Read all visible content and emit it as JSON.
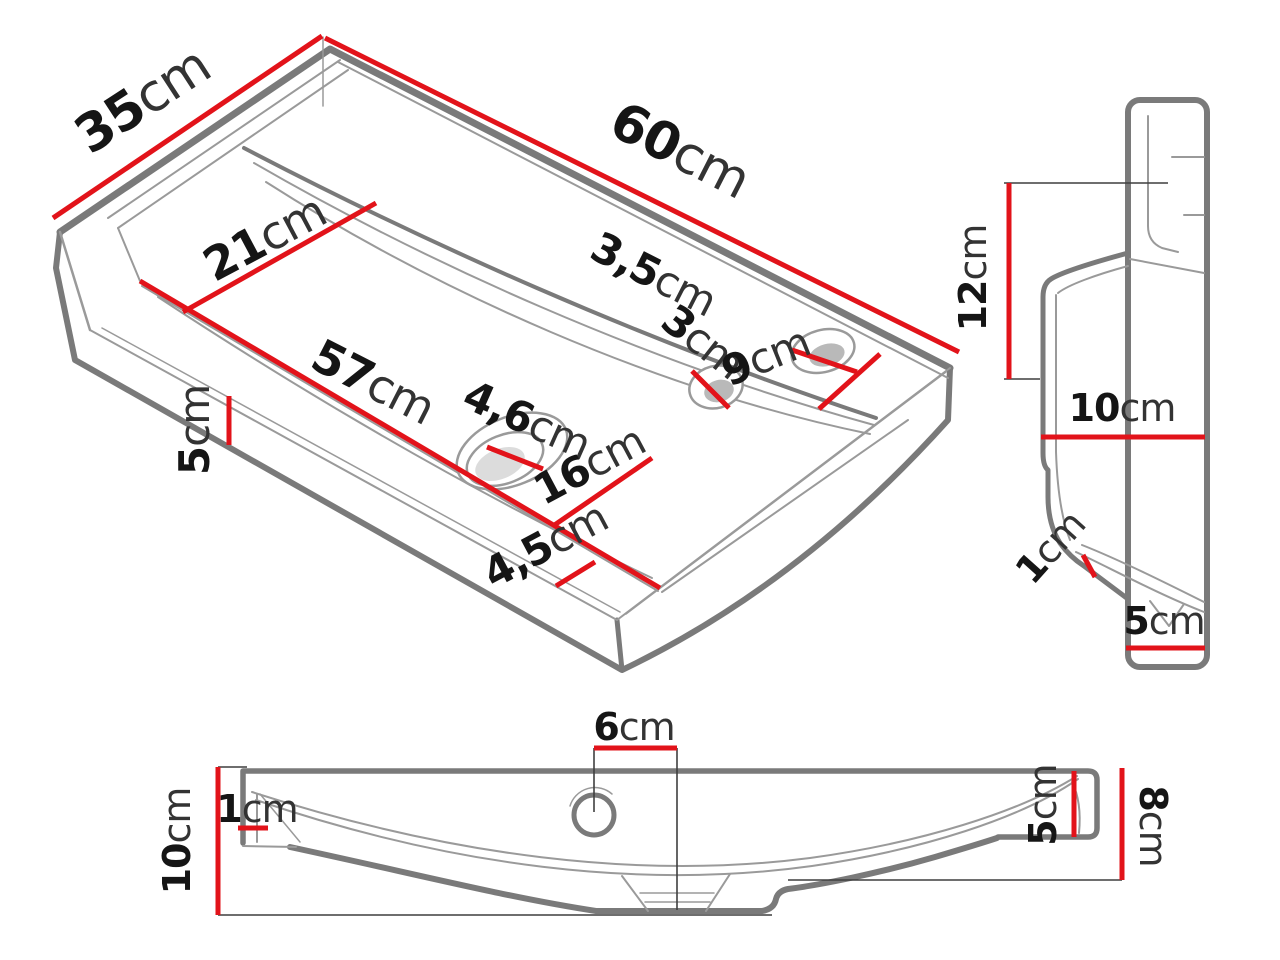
{
  "figure": {
    "kind": "washbasin-dimension-drawing",
    "background": "#ffffff"
  },
  "colors": {
    "dimension_red": "#e2131a",
    "outline_gray": "#7a7a7a",
    "thin_gray": "#9a9a9a",
    "label_black": "#151515"
  },
  "views": {
    "isometric": {
      "name": "isometric-top-view",
      "dims": {
        "depth": {
          "num": "35",
          "unit": "cm"
        },
        "length": {
          "num": "60",
          "unit": "cm"
        },
        "basin_depth": {
          "num": "21",
          "unit": "cm"
        },
        "basin_length": {
          "num": "57",
          "unit": "cm"
        },
        "edge_height": {
          "num": "5",
          "unit": "cm"
        },
        "overflow_hole": {
          "num": "3",
          "unit": "cm"
        },
        "faucet_hole": {
          "num": "3,5",
          "unit": "cm"
        },
        "rim_right": {
          "num": "9",
          "unit": "cm"
        },
        "drain_hole": {
          "num": "4,6",
          "unit": "cm"
        },
        "basin_front": {
          "num": "16",
          "unit": "cm"
        },
        "rim_front": {
          "num": "4,5",
          "unit": "cm"
        }
      }
    },
    "side": {
      "name": "side-profile-view",
      "dims": {
        "height_upper": {
          "num": "12",
          "unit": "cm"
        },
        "depth_mid": {
          "num": "10",
          "unit": "cm"
        },
        "lip": {
          "num": "1",
          "unit": "cm"
        },
        "base": {
          "num": "5",
          "unit": "cm"
        }
      }
    },
    "front": {
      "name": "front-section-view",
      "dims": {
        "hole_offset": {
          "num": "6",
          "unit": "cm"
        },
        "wall": {
          "num": "1",
          "unit": "cm"
        },
        "height": {
          "num": "10",
          "unit": "cm"
        },
        "right_inner": {
          "num": "5",
          "unit": "cm"
        },
        "right_outer": {
          "num": "8",
          "unit": "cm"
        }
      }
    }
  }
}
